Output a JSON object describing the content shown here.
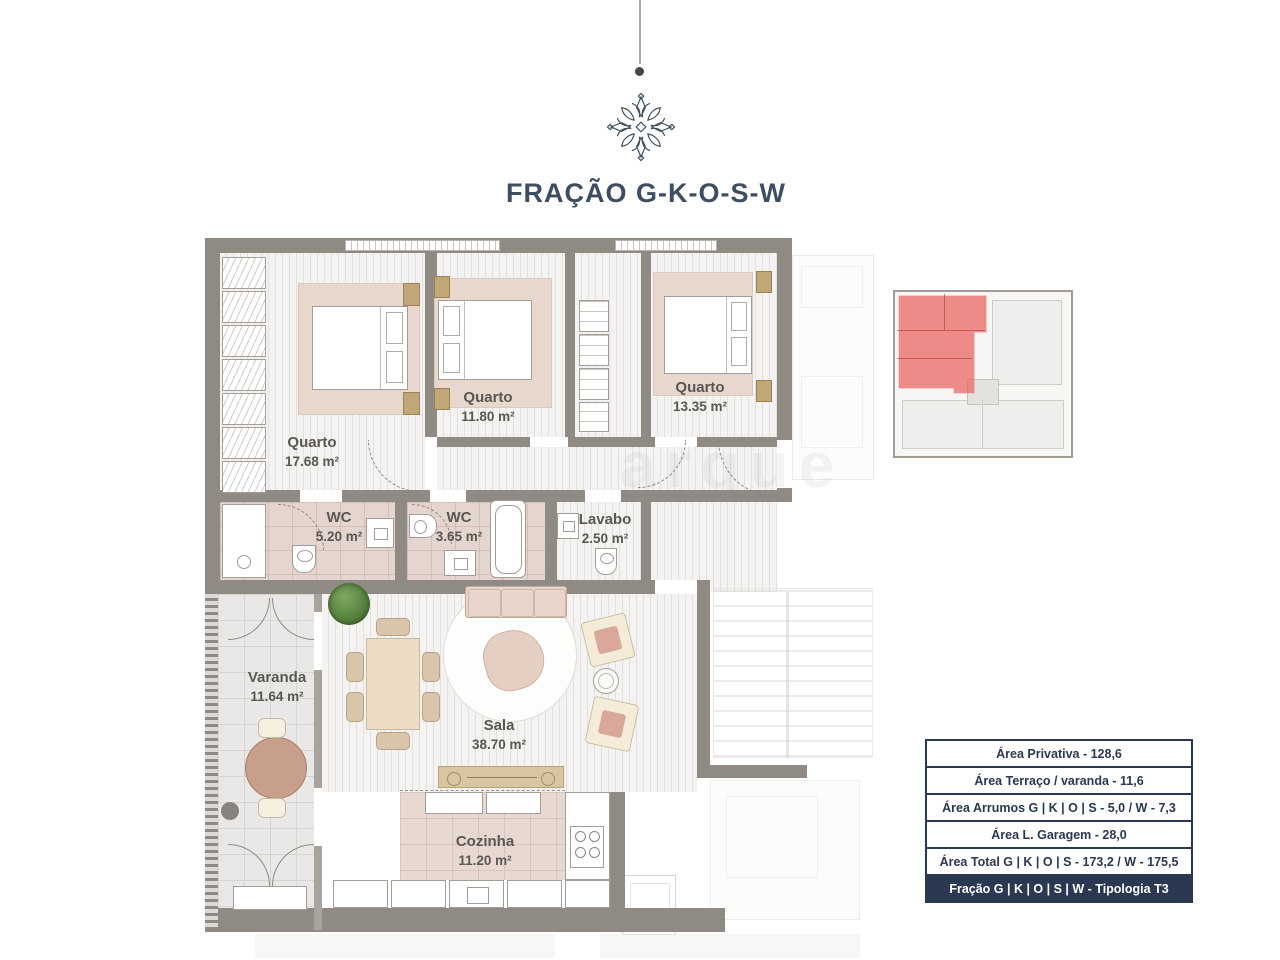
{
  "header": {
    "title": "FRAÇÃO G-K-O-S-W",
    "logo_icon": "floral-ornament-icon"
  },
  "watermark": "arque",
  "floor_plan": {
    "rooms": [
      {
        "name": "Quarto",
        "area": "17.68 m²"
      },
      {
        "name": "Quarto",
        "area": "11.80 m²"
      },
      {
        "name": "Quarto",
        "area": "13.35 m²"
      },
      {
        "name": "WC",
        "area": "5.20 m²"
      },
      {
        "name": "WC",
        "area": "3.65 m²"
      },
      {
        "name": "Lavabo",
        "area": "2.50 m²"
      },
      {
        "name": "Varanda",
        "area": "11.64 m²"
      },
      {
        "name": "Sala",
        "area": "38.70 m²"
      },
      {
        "name": "Cozinha",
        "area": "11.20 m²"
      }
    ],
    "colors": {
      "wall": "#8f8a84",
      "bath_floor": "#e4d5cf",
      "kitchen_floor": "#e7d8d2",
      "rug": "#e7d7cd",
      "accent_red": "#ea7a74"
    }
  },
  "key_plan": {
    "description": "building key plan, fraction highlighted top-left",
    "highlight_color": "#ea7a74"
  },
  "area_table": {
    "rows": [
      "Área Privativa - 128,6",
      "Área Terraço / varanda - 11,6",
      "Área Arrumos G | K | O | S - 5,0 / W - 7,3",
      "Área L. Garagem - 28,0",
      "Área Total G | K | O | S - 173,2 / W - 175,5",
      "Fração G | K | O | S | W - Tipologia T3"
    ]
  }
}
